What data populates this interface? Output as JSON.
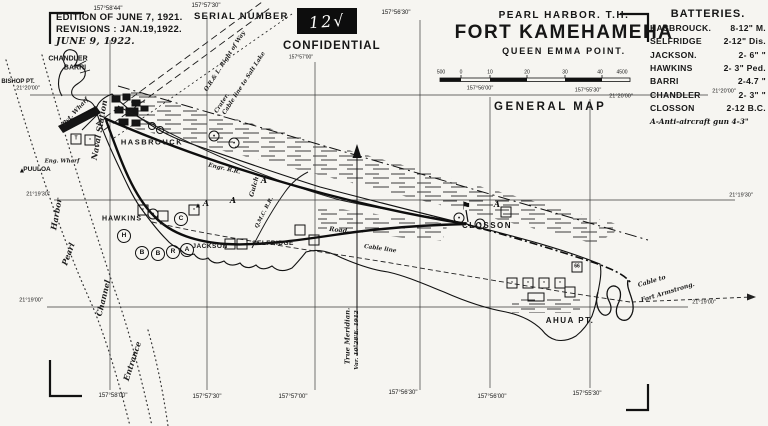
{
  "edition": {
    "line1": "EDITION OF JUNE 7, 1921.",
    "line2": "REVISIONS : JAN.19,1922.",
    "line3": "JUNE 9, 1922."
  },
  "serial": {
    "label": "SERIAL NUMBER",
    "number": "12√"
  },
  "confidential": "CONFIDENTIAL",
  "title": {
    "region": "PEARL HARBOR. T.H.",
    "fort": "FORT KAMEHAMEHA",
    "subtitle": "QUEEN EMMA POINT.",
    "map_type": "GENERAL MAP"
  },
  "batteries": {
    "heading": "BATTERIES.",
    "items": [
      {
        "name": "HASBROUCK.",
        "guns": "8-12\" M."
      },
      {
        "name": "SELFRIDGE",
        "guns": "2-12\" Dis."
      },
      {
        "name": "JACKSON.",
        "guns": "2- 6\"  \""
      },
      {
        "name": "HAWKINS",
        "guns": "2- 3\" Ped."
      },
      {
        "name": "BARRI",
        "guns": "2-4.7  \""
      },
      {
        "name": "CHANDLER",
        "guns": "2- 3\"  \""
      },
      {
        "name": "CLOSSON",
        "guns": "2-12 B.C."
      }
    ],
    "footnote": "A-Anti-aircraft gun 4-3\""
  },
  "map": {
    "ink_color": "#161616",
    "paper_color": "#f6f5f1",
    "labels": [
      {
        "t": "CHANDLER",
        "x": 68,
        "y": 59,
        "s": 7,
        "b": 1,
        "g": "feature"
      },
      {
        "t": "BARRI",
        "x": 75,
        "y": 68,
        "s": 7,
        "b": 1,
        "g": "feature"
      },
      {
        "t": "BISHOP PT.",
        "x": 18,
        "y": 82,
        "s": 6,
        "b": 1,
        "g": "feature"
      },
      {
        "t": "PUULOA",
        "x": 37,
        "y": 170,
        "s": 6.5,
        "b": 1,
        "g": "feature"
      },
      {
        "t": "HASBROUCK",
        "x": 152,
        "y": 142,
        "s": 7.5,
        "b": 1,
        "sp": 1.5,
        "g": "feature"
      },
      {
        "t": "HAWKINS",
        "x": 122,
        "y": 219,
        "s": 7,
        "b": 1,
        "sp": 1,
        "g": "feature"
      },
      {
        "t": "JACKSON",
        "x": 210,
        "y": 247,
        "s": 6.5,
        "b": 1,
        "sp": 0.5,
        "g": "feature"
      },
      {
        "t": "SELFRIDGE",
        "x": 273,
        "y": 244,
        "s": 6.5,
        "b": 1,
        "sp": 0.5,
        "g": "feature"
      },
      {
        "t": "CLOSSON",
        "x": 487,
        "y": 226,
        "s": 8,
        "b": 1,
        "sp": 1.5,
        "g": "feature"
      },
      {
        "t": "AHUA PT.",
        "x": 570,
        "y": 321,
        "s": 8,
        "b": 1,
        "sp": 1.5,
        "g": "feature"
      },
      {
        "t": "Pvt. Wharf",
        "x": 76,
        "y": 112,
        "s": 6,
        "i": 1,
        "r": -48,
        "g": "feature"
      },
      {
        "t": "Eng. Wharf",
        "x": 62,
        "y": 162,
        "s": 5.5,
        "i": 1,
        "g": "feature"
      },
      {
        "t": "Naval Station",
        "x": 99,
        "y": 130,
        "s": 8,
        "i": 1,
        "r": -80,
        "g": "channel"
      },
      {
        "t": "Harbor",
        "x": 56,
        "y": 214,
        "s": 8,
        "i": 1,
        "r": -80,
        "g": "channel"
      },
      {
        "t": "Pearl",
        "x": 68,
        "y": 254,
        "s": 8,
        "i": 1,
        "r": -70,
        "g": "channel"
      },
      {
        "t": "Channel",
        "x": 103,
        "y": 298,
        "s": 8,
        "i": 1,
        "r": -76,
        "g": "channel"
      },
      {
        "t": "Entrance",
        "x": 132,
        "y": 361,
        "s": 8,
        "i": 1,
        "r": -72,
        "g": "channel"
      },
      {
        "t": "O.R.& L. Right of Way",
        "x": 226,
        "y": 62,
        "s": 5.8,
        "i": 1,
        "r": -57,
        "g": "line-label"
      },
      {
        "t": "Cable line to Salt Lake",
        "x": 245,
        "y": 84,
        "s": 5.8,
        "i": 1,
        "r": -57,
        "g": "line-label"
      },
      {
        "t": "Crater.",
        "x": 223,
        "y": 104,
        "s": 5.8,
        "i": 1,
        "r": -57,
        "g": "line-label"
      },
      {
        "t": "Engr. R.R.",
        "x": 224,
        "y": 170,
        "s": 5.8,
        "i": 1,
        "r": 13,
        "g": "line-label"
      },
      {
        "t": "Gulch",
        "x": 255,
        "y": 187,
        "s": 6.3,
        "i": 1,
        "r": -75,
        "g": "line-label"
      },
      {
        "t": "Q.M.C. R.R.",
        "x": 265,
        "y": 213,
        "s": 5.3,
        "i": 1,
        "r": -63,
        "g": "line-label"
      },
      {
        "t": "Road",
        "x": 338,
        "y": 231,
        "s": 6.3,
        "i": 1,
        "r": 6,
        "g": "line-label"
      },
      {
        "t": "Cable line",
        "x": 380,
        "y": 250,
        "s": 5.8,
        "i": 1,
        "r": 8,
        "g": "line-label"
      },
      {
        "t": "Cable to",
        "x": 652,
        "y": 282,
        "s": 6.2,
        "i": 1,
        "r": -17,
        "g": "line-label"
      },
      {
        "t": "Fort Armstrong.",
        "x": 668,
        "y": 293,
        "s": 6.2,
        "i": 1,
        "r": -17,
        "g": "line-label"
      },
      {
        "t": "True Meridian.",
        "x": 348,
        "y": 336,
        "s": 6.8,
        "i": 1,
        "r": -90,
        "g": "line-label"
      },
      {
        "t": "Var. 10°28'E. 1912",
        "x": 358,
        "y": 340,
        "s": 5.8,
        "i": 1,
        "r": -90,
        "g": "line-label"
      },
      {
        "t": "157°58'44\"",
        "x": 108,
        "y": 9,
        "s": 6,
        "g": "coord"
      },
      {
        "t": "157°57'30\"",
        "x": 206,
        "y": 6,
        "s": 6,
        "g": "coord"
      },
      {
        "t": "157°56'30\"",
        "x": 396,
        "y": 13,
        "s": 6,
        "g": "coord"
      },
      {
        "t": "157°57'00\"",
        "x": 301,
        "y": 58,
        "s": 5,
        "g": "coord"
      },
      {
        "t": "157°56'00\"",
        "x": 480,
        "y": 89,
        "s": 5.5,
        "g": "coord"
      },
      {
        "t": "157°55'30\"",
        "x": 588,
        "y": 91,
        "s": 5.5,
        "g": "coord"
      },
      {
        "t": "21°20'00\"",
        "x": 621,
        "y": 97,
        "s": 5.5,
        "g": "coord"
      },
      {
        "t": "157°58'00\"",
        "x": 113,
        "y": 396,
        "s": 6,
        "g": "coord"
      },
      {
        "t": "157°57'30\"",
        "x": 207,
        "y": 397,
        "s": 6,
        "g": "coord"
      },
      {
        "t": "157°57'00\"",
        "x": 293,
        "y": 397,
        "s": 6,
        "g": "coord"
      },
      {
        "t": "157°56'30\"",
        "x": 403,
        "y": 393,
        "s": 6,
        "g": "coord"
      },
      {
        "t": "157°56'00\"",
        "x": 492,
        "y": 397,
        "s": 6,
        "g": "coord"
      },
      {
        "t": "157°55'30\"",
        "x": 587,
        "y": 394,
        "s": 6,
        "g": "coord"
      },
      {
        "t": "21°20'00\"",
        "x": 28,
        "y": 89,
        "s": 5.5,
        "g": "coord"
      },
      {
        "t": "21°19'30\"",
        "x": 38,
        "y": 195,
        "s": 5.5,
        "g": "coord"
      },
      {
        "t": "21°19'00\"",
        "x": 31,
        "y": 301,
        "s": 5.5,
        "g": "coord"
      },
      {
        "t": "21°20'00\"",
        "x": 724,
        "y": 92,
        "s": 5.5,
        "g": "coord"
      },
      {
        "t": "21°19'30\"",
        "x": 741,
        "y": 196,
        "s": 5.5,
        "g": "coord"
      },
      {
        "t": "21°19'00\"",
        "x": 704,
        "y": 303,
        "s": 5.5,
        "g": "coord"
      },
      {
        "t": "500",
        "x": 441,
        "y": 73,
        "s": 5,
        "g": "scale"
      },
      {
        "t": "0",
        "x": 461,
        "y": 73,
        "s": 5,
        "g": "scale"
      },
      {
        "t": "10",
        "x": 490,
        "y": 73,
        "s": 5,
        "g": "scale"
      },
      {
        "t": "20",
        "x": 527,
        "y": 73,
        "s": 5,
        "g": "scale"
      },
      {
        "t": "30",
        "x": 565,
        "y": 73,
        "s": 5,
        "g": "scale"
      },
      {
        "t": "40",
        "x": 600,
        "y": 73,
        "s": 5,
        "g": "scale"
      },
      {
        "t": "4500",
        "x": 622,
        "y": 73,
        "s": 5,
        "g": "scale"
      }
    ],
    "symbols": [
      {
        "k": "tri",
        "x": 22,
        "y": 171
      },
      {
        "k": "sq",
        "x": 76,
        "y": 139,
        "c": "T"
      },
      {
        "k": "sq",
        "x": 90,
        "y": 140,
        "c": "▪"
      },
      {
        "k": "gun",
        "x": 214,
        "y": 136,
        "c": "•"
      },
      {
        "k": "gun",
        "x": 234,
        "y": 143,
        "c": "•"
      },
      {
        "k": "sq",
        "x": 143,
        "y": 210,
        "c": "▪"
      },
      {
        "k": "gun",
        "x": 153,
        "y": 214,
        "c": "•"
      },
      {
        "k": "sq",
        "x": 163,
        "y": 216
      },
      {
        "k": "circ",
        "x": 181,
        "y": 219,
        "c": "C"
      },
      {
        "k": "sq",
        "x": 194,
        "y": 210,
        "c": "▪"
      },
      {
        "k": "tri",
        "x": 198,
        "y": 206
      },
      {
        "k": "let",
        "x": 206,
        "y": 203,
        "c": "A"
      },
      {
        "k": "let",
        "x": 233,
        "y": 200,
        "c": "A"
      },
      {
        "k": "let",
        "x": 264,
        "y": 180,
        "c": "A"
      },
      {
        "k": "circ",
        "x": 124,
        "y": 236,
        "c": "H"
      },
      {
        "k": "circ",
        "x": 142,
        "y": 253,
        "c": "B"
      },
      {
        "k": "circ",
        "x": 158,
        "y": 254,
        "c": "B"
      },
      {
        "k": "circ",
        "x": 173,
        "y": 252,
        "c": "R"
      },
      {
        "k": "circ",
        "x": 187,
        "y": 250,
        "c": "A"
      },
      {
        "k": "sq",
        "x": 230,
        "y": 244
      },
      {
        "k": "sq",
        "x": 242,
        "y": 244
      },
      {
        "k": "sq",
        "x": 300,
        "y": 230
      },
      {
        "k": "sq",
        "x": 314,
        "y": 240
      },
      {
        "k": "flag",
        "x": 466,
        "y": 207
      },
      {
        "k": "gun",
        "x": 459,
        "y": 218,
        "c": "•"
      },
      {
        "k": "gun",
        "x": 480,
        "y": 224,
        "c": "•"
      },
      {
        "k": "sq",
        "x": 506,
        "y": 212
      },
      {
        "k": "let",
        "x": 497,
        "y": 204,
        "c": "A"
      },
      {
        "k": "sq",
        "x": 512,
        "y": 283,
        "c": "▪"
      },
      {
        "k": "sq",
        "x": 528,
        "y": 283,
        "c": "▪"
      },
      {
        "k": "sq",
        "x": 544,
        "y": 283,
        "c": "▪"
      },
      {
        "k": "sq",
        "x": 560,
        "y": 283,
        "c": "▪"
      },
      {
        "k": "rect",
        "x": 536,
        "y": 297
      },
      {
        "k": "sq",
        "x": 570,
        "y": 292
      },
      {
        "k": "sq",
        "x": 577,
        "y": 267,
        "c": "66"
      }
    ]
  }
}
